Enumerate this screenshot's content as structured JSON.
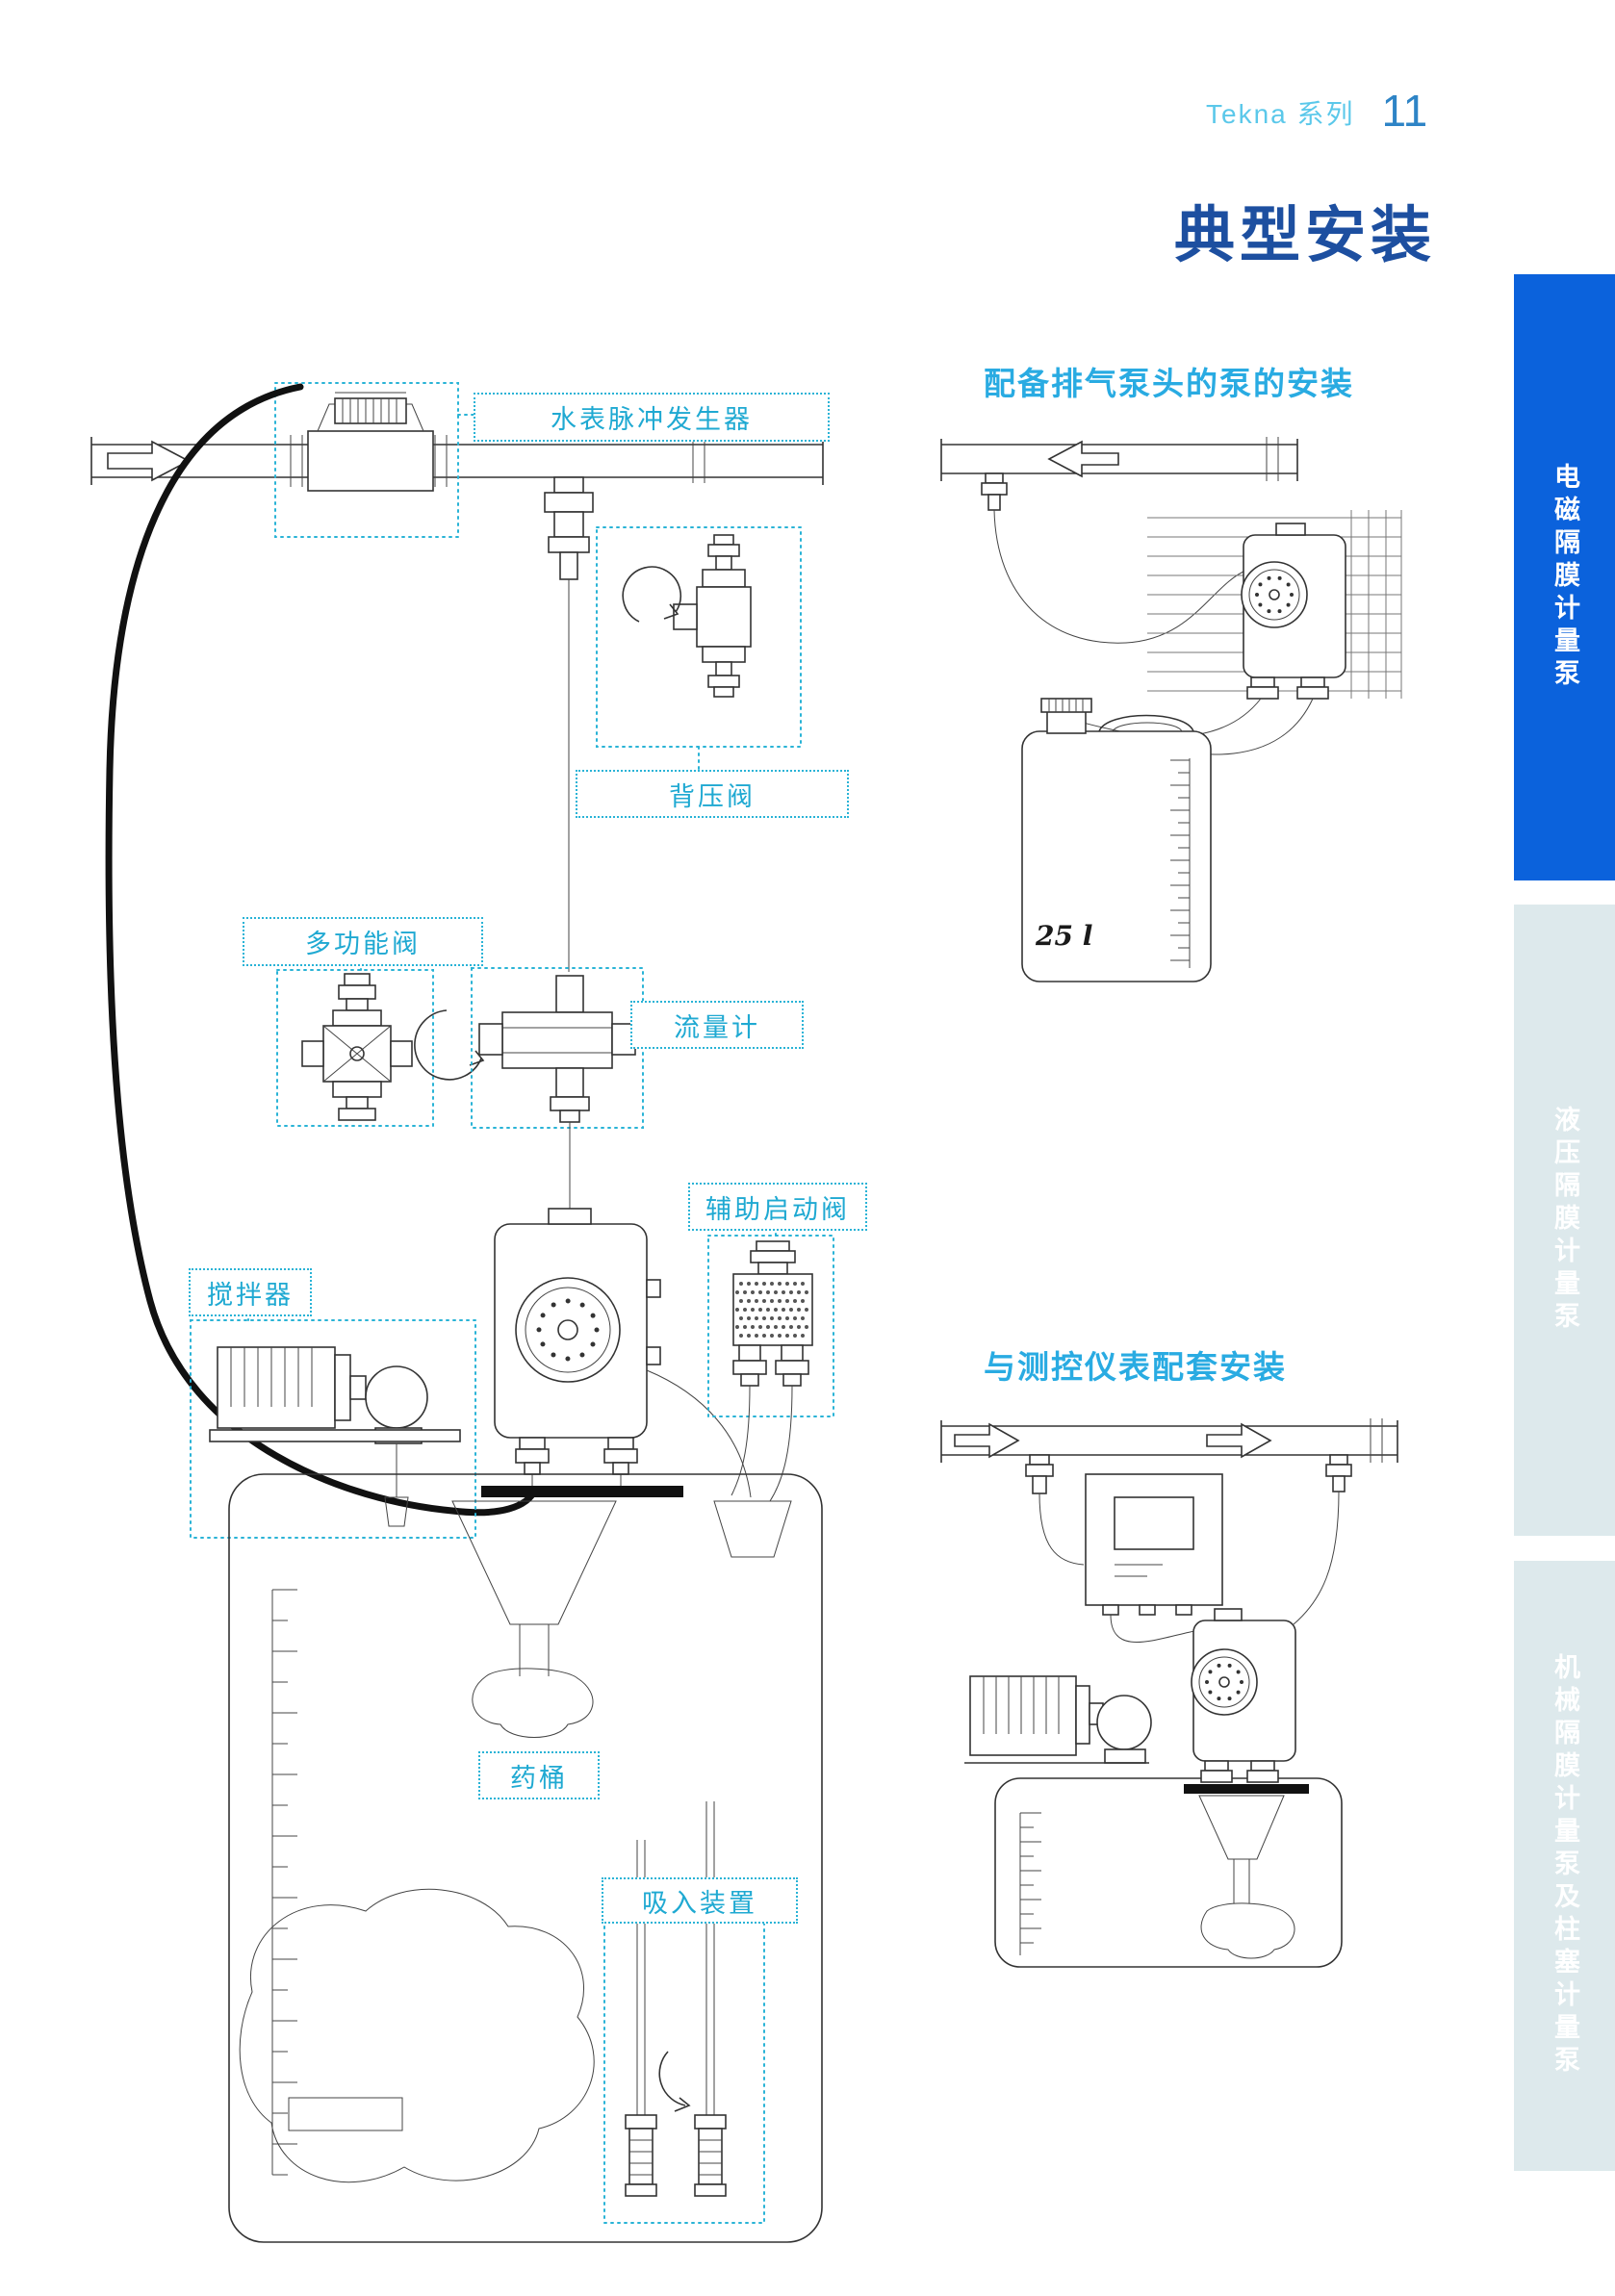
{
  "header": {
    "series": "Tekna 系列",
    "page_number": "11"
  },
  "title": "典型安装",
  "diagram_labels": {
    "water_meter": "水表脉冲发生器",
    "back_pressure_valve": "背压阀",
    "multifunction_valve": "多功能阀",
    "flow_meter": "流量计",
    "aux_priming_valve": "辅助启动阀",
    "mixer": "搅拌器",
    "chemical_tank": "药桶",
    "suction_device": "吸入装置"
  },
  "sections": {
    "degassing": {
      "heading": "配备排气泵头的泵的安装",
      "tank_volume": "25 l"
    },
    "instrument": {
      "heading": "与测控仪表配套安装"
    }
  },
  "sidebar": {
    "tabs": [
      {
        "label": "电磁隔膜计量泵",
        "active": true
      },
      {
        "label": "液压隔膜计量泵",
        "active": false
      },
      {
        "label": "机械隔膜计量泵及柱塞计量泵",
        "active": false
      }
    ]
  },
  "colors": {
    "title_blue": "#1d4fa0",
    "heading_cyan": "#29abe2",
    "label_cyan": "#1fa9d2",
    "sidebar_active_blue": "#0b62dc",
    "sidebar_inactive_gray": "#dde9ec"
  }
}
